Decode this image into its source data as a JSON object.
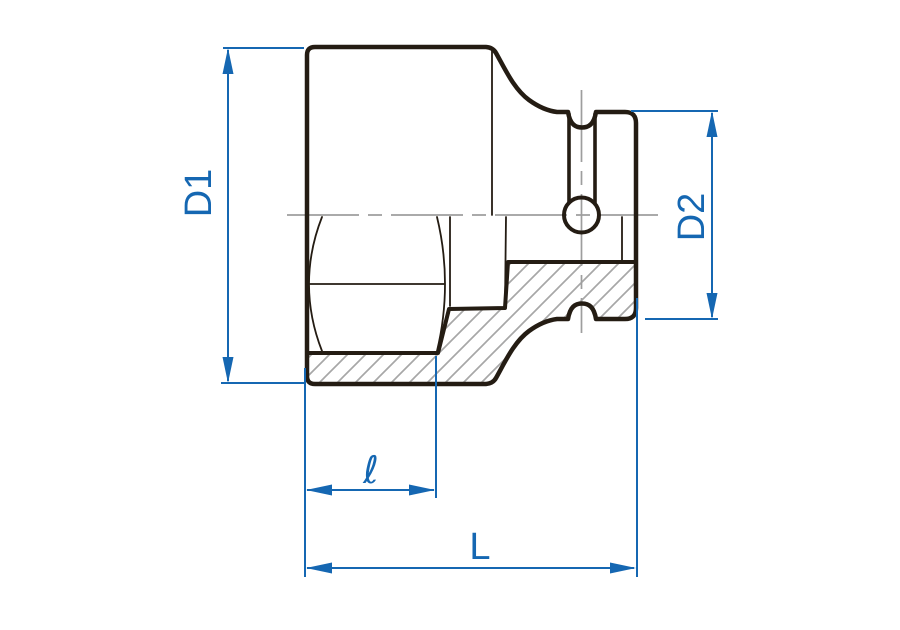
{
  "diagram": {
    "kind": "engineering-drawing",
    "subject": "hex socket with square drive, half-section side view",
    "labels": {
      "d1": "D1",
      "d2": "D2",
      "ell": "ℓ",
      "overall": "L"
    },
    "colors": {
      "dimension_blue": "#1567b2",
      "outline_black": "#241c13",
      "centerline_gray": "#9e9e9e",
      "hatch_gray": "#a7a7a7",
      "background": "#ffffff"
    }
  }
}
